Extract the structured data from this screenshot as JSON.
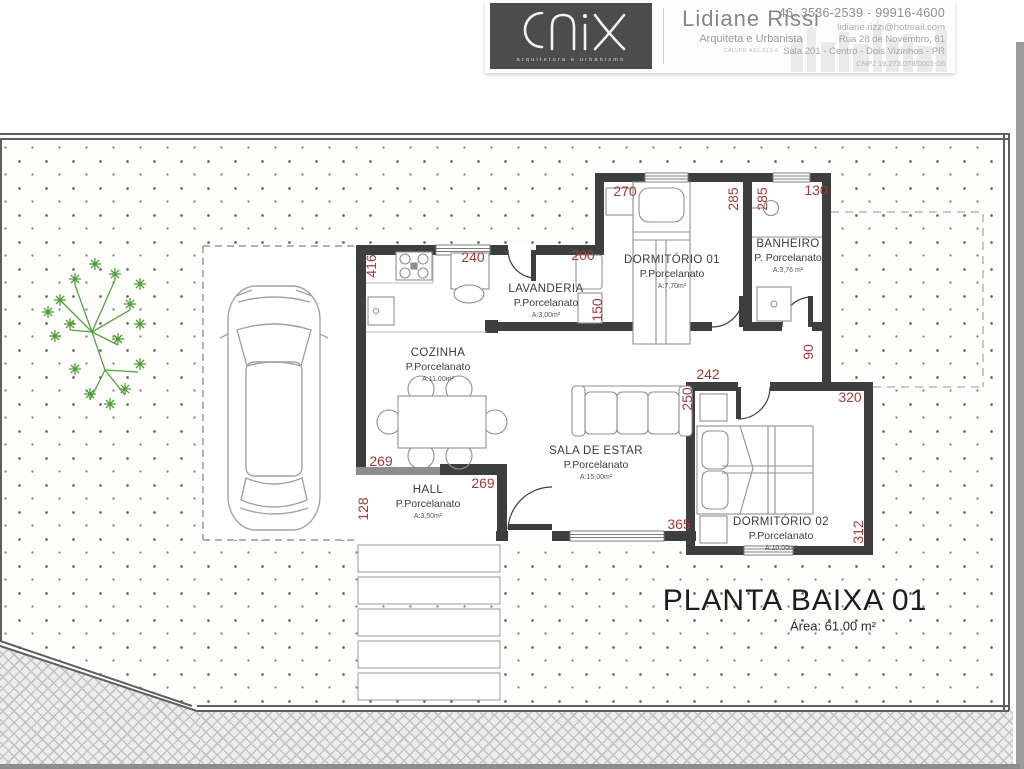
{
  "title_block": {
    "logo_text": "ONIX",
    "logo_subtext": "arquitetura e urbanismo",
    "architect_name": "Lidiane Rissi",
    "architect_title": "Arquiteta e Urbanista",
    "architect_registration": "CAU/PR A61.213-6",
    "phone": "46. 3536-2539  -  99916-4600",
    "email": "lidiane.rizzi@hotmail.com",
    "address_line1": "Rua 28 de Novembro, 81",
    "address_line2": "Sala 201 - Centro - Dois Vizinhos - PR",
    "cnpj": "CNPJ 19.273.078/0001-06"
  },
  "plan": {
    "title": "PLANTA BAIXA 01",
    "total_area": "Área: 61.00 m²",
    "rooms": [
      {
        "name": "DORMITÓRIO 01",
        "floor": "P.Porcelanato",
        "area": "A:7,70m²"
      },
      {
        "name": "BANHEIRO",
        "floor": "P. Porcelanato",
        "area": "A:3,76 m²"
      },
      {
        "name": "LAVANDERIA",
        "floor": "P.Porcelanato",
        "area": "A:3,00m²"
      },
      {
        "name": "COZINHA",
        "floor": "P.Porcelanato",
        "area": "A:11,00m²"
      },
      {
        "name": "SALA DE ESTAR",
        "floor": "P.Porcelanato",
        "area": "A:15,00m²"
      },
      {
        "name": "HALL",
        "floor": "P.Porcelanato",
        "area": "A:3,50m²"
      },
      {
        "name": "DORMITÓRIO 02",
        "floor": "P.Porcelanato",
        "area": "A:10,00m²"
      }
    ],
    "dimensions": [
      "270",
      "285",
      "285",
      "130",
      "416",
      "240",
      "200",
      "150",
      "269",
      "128",
      "269",
      "242",
      "250",
      "90",
      "320",
      "365",
      "312"
    ],
    "colors": {
      "wall": "#3e3e3e",
      "dimension": "#a03c38",
      "tree": "#57a33e",
      "accent_logo": "#4c4c4c"
    }
  }
}
